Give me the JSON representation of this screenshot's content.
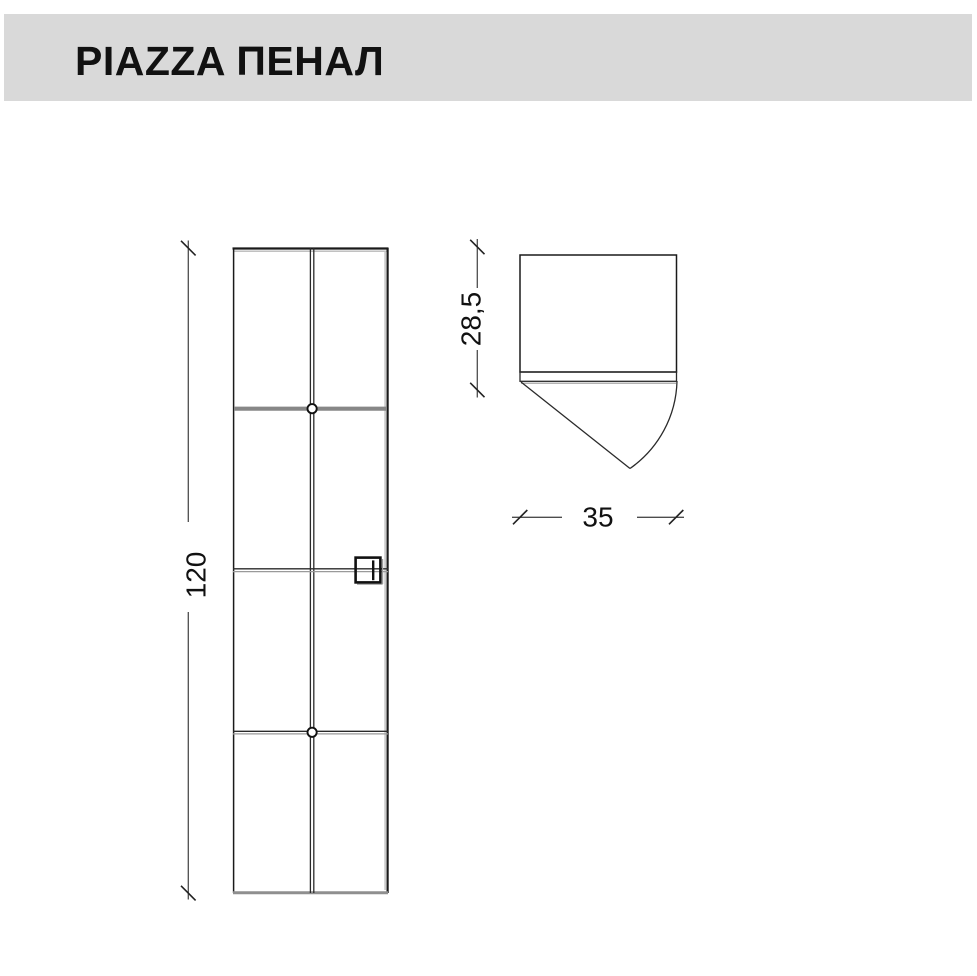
{
  "header": {
    "title": "PIAZZA ПЕНАЛ"
  },
  "dimensions": {
    "height": "120",
    "depth": "28,5",
    "width": "35"
  },
  "drawing": {
    "type": "furniture-technical-drawing",
    "views": [
      "front",
      "top"
    ],
    "front_view": {
      "doors": 2,
      "sections": 4,
      "knobs_on_center_line": 2,
      "handle": "square-handle-right-door"
    },
    "top_view": {
      "door_swing_arc": true
    }
  },
  "colors": {
    "header_bg": "#d9d9d9",
    "title_text": "#111111",
    "outline": "#1a1a1a",
    "shelf_gray": "#878787",
    "dimension_line": "#4d4d4d",
    "dimension_text": "#111111",
    "background": "#ffffff"
  }
}
